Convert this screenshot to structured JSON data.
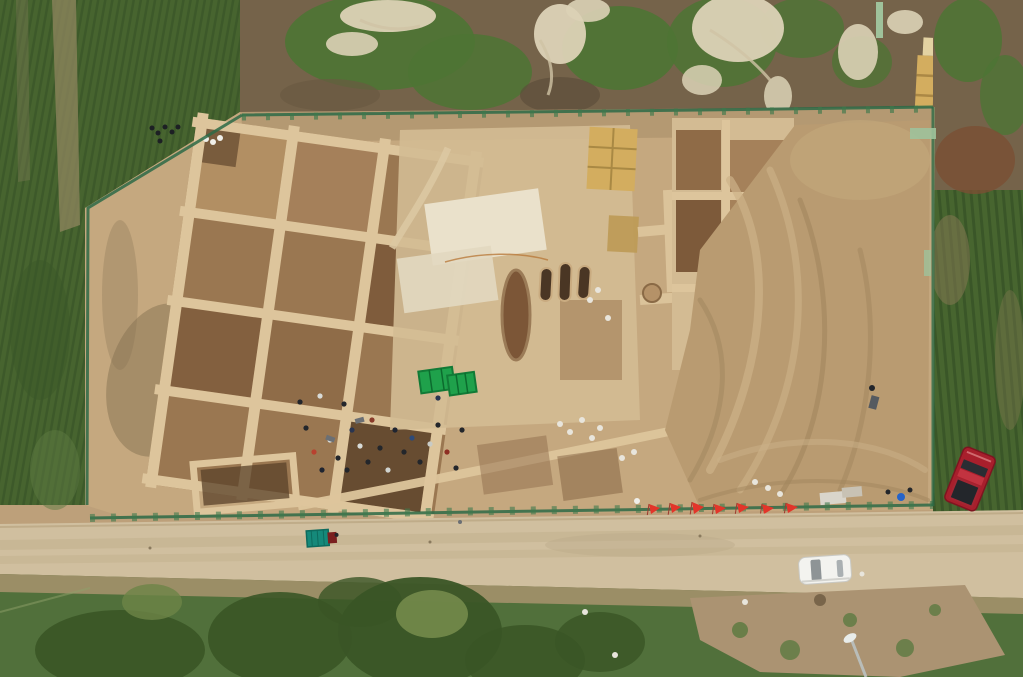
{
  "scene": {
    "description": "Aerial drone photograph of a large rectangular archaeological excavation site with a grid of square dig pits and baulks, surrounded by green crop fields, bordered by a dirt road at the bottom with a white car, a teal cargo tricycle, a parked red pickup truck, red survey flags, green tarps, straw bales and workers scattered across the dig",
    "features": {
      "red_flag_count": 7,
      "green_tarp_count": 2,
      "grave_capsule_count": 3,
      "vehicle_count": 3
    },
    "vehicles": [
      {
        "name": "white-sedan",
        "location": "on dirt road, bottom right"
      },
      {
        "name": "red-pickup-truck",
        "location": "parked on dirt, right edge"
      },
      {
        "name": "teal-cargo-tricycle",
        "location": "on dirt road, bottom left"
      }
    ]
  },
  "colors": {
    "crop-green": "#47652f",
    "crop-row-dark": "#3a5628",
    "veg-brown": "#75634a",
    "veg-top-green": "#4e7434",
    "dead-branches": "#dcd2b6",
    "dirt-base": "#bda07a",
    "dirt-light": "#d3bb93",
    "excavation-base": "#c5a87f",
    "baulk-light": "#ddc59c",
    "pit-brown": "#9a7751",
    "pit-dark": "#7f5c3c",
    "pit-deep": "#5a4129",
    "floor-pale": "#eae1cb",
    "straw-yellow": "#d3ad5f",
    "spoil-tan": "#b99b71",
    "track-light": "#cdb289",
    "shadow-olive": "#857252",
    "road-surface": "#d0bf9f",
    "road-shoulder": "#a8936f",
    "fence-green": "#2d6a46",
    "fence-light": "#9fc29b",
    "tarp-green": "#1fa14b",
    "flag-red": "#e2352a",
    "car-red": "#a81f2c",
    "car-white": "#f3f3ef",
    "trike-teal": "#15897a",
    "grass-bottom": "#51703b",
    "tree-dark": "#3a5526",
    "grass-light": "#7c9150",
    "dirt-patch": "#ab9372"
  }
}
